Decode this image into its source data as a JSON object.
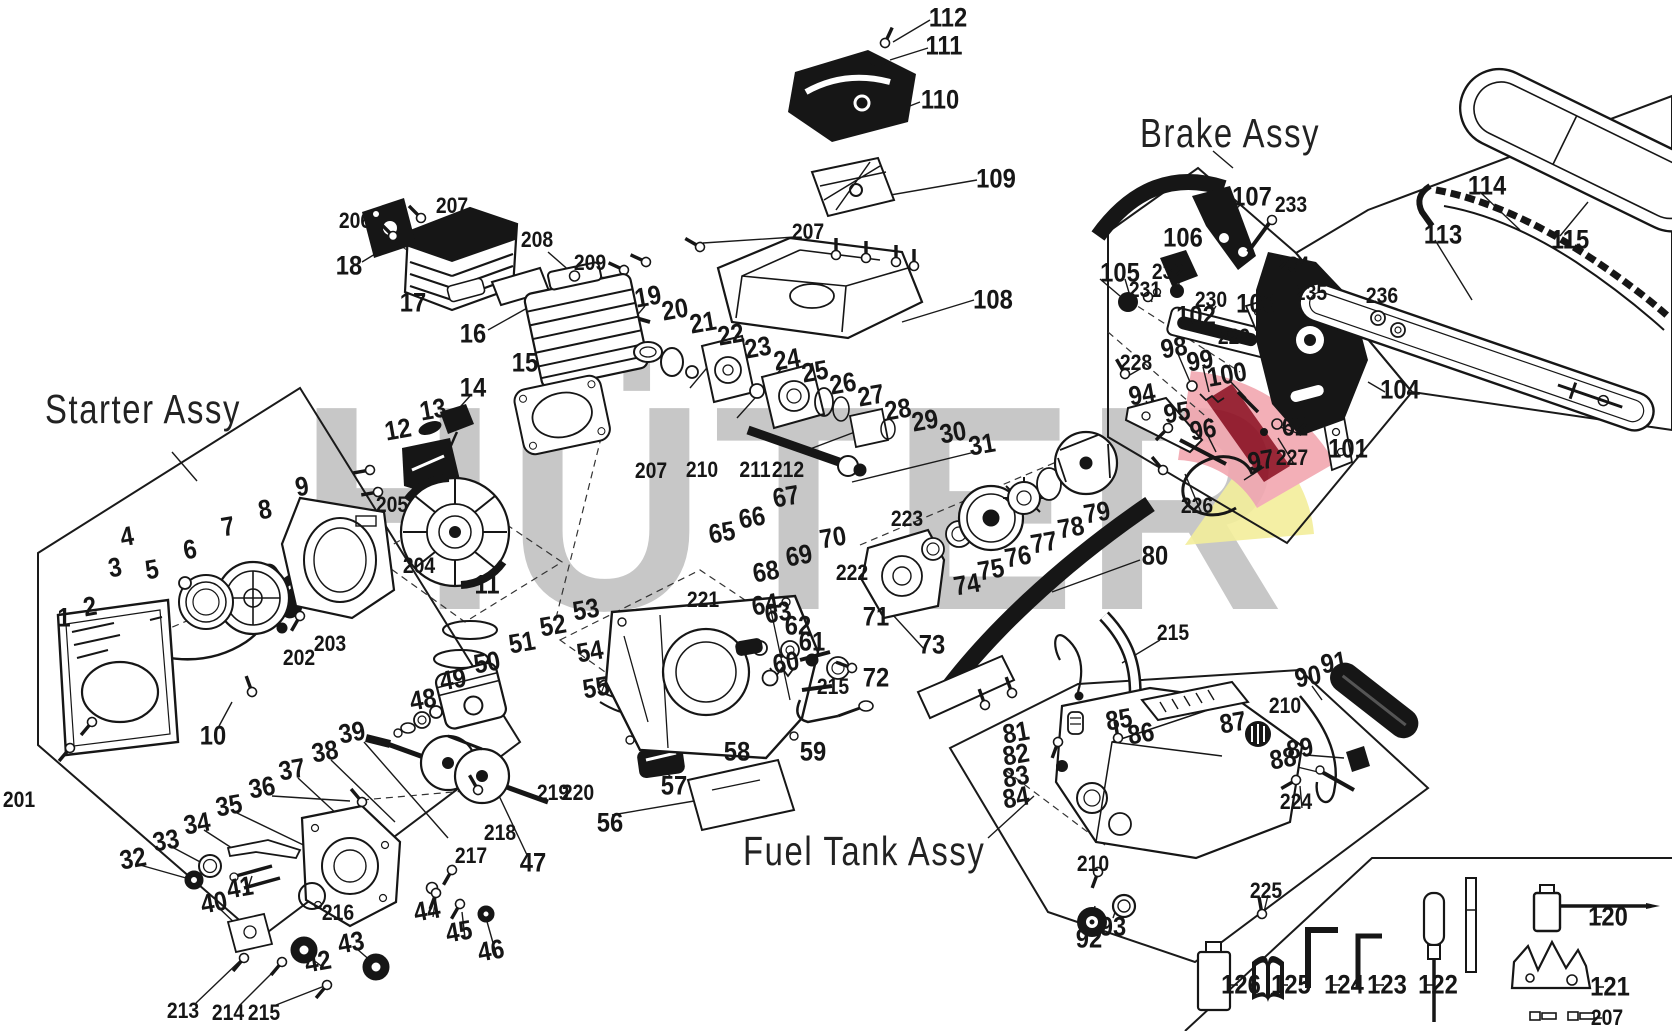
{
  "watermark": {
    "text": "HÜTER",
    "color": "#c7c7c7"
  },
  "logo_colors": {
    "pink": "#f2a7b0",
    "dark_red": "#8f1022",
    "yellow": "#f3ee9b"
  },
  "assy_labels": [
    {
      "id": "starter",
      "text": "Starter Assy"
    },
    {
      "id": "brake",
      "text": "Brake Assy"
    },
    {
      "id": "fuel",
      "text": "Fuel Tank Assy"
    }
  ],
  "legend_tools": [
    {
      "n": "126",
      "name": "oil-bottle"
    },
    {
      "n": "125",
      "name": "manual-book"
    },
    {
      "n": "124",
      "name": "hex-wrench-large"
    },
    {
      "n": "123",
      "name": "hex-wrench-small"
    },
    {
      "n": "122",
      "name": "screwdriver"
    },
    {
      "n": "120",
      "name": "spark-plug-wrench"
    },
    {
      "n": "121",
      "name": "bumper-spike"
    },
    {
      "n": "207",
      "name": "screws"
    }
  ],
  "callouts": [
    [
      "112",
      948,
      18,
      0
    ],
    [
      "111",
      944,
      46,
      0
    ],
    [
      "110",
      940,
      100,
      0
    ],
    [
      "109",
      996,
      179,
      0
    ],
    [
      "207",
      808,
      232,
      0
    ],
    [
      "108",
      993,
      300,
      0
    ],
    [
      "206",
      355,
      221,
      0
    ],
    [
      "207",
      452,
      206,
      0
    ],
    [
      "18",
      349,
      266,
      0
    ],
    [
      "17",
      413,
      303,
      0
    ],
    [
      "16",
      473,
      334,
      0
    ],
    [
      "208",
      537,
      240,
      0
    ],
    [
      "209",
      590,
      263,
      0
    ],
    [
      "15",
      525,
      363,
      0
    ],
    [
      "14",
      473,
      388,
      0
    ],
    [
      "13",
      433,
      410
    ],
    [
      "12",
      398,
      430
    ],
    [
      "19",
      648,
      297
    ],
    [
      "20",
      675,
      310
    ],
    [
      "21",
      703,
      323
    ],
    [
      "22",
      731,
      335
    ],
    [
      "23",
      758,
      348
    ],
    [
      "24",
      787,
      360
    ],
    [
      "25",
      815,
      372
    ],
    [
      "26",
      843,
      384
    ],
    [
      "27",
      871,
      396
    ],
    [
      "28",
      898,
      410
    ],
    [
      "29",
      925,
      421
    ],
    [
      "30",
      953,
      433
    ],
    [
      "31",
      982,
      445
    ],
    [
      "205",
      392,
      505,
      0
    ],
    [
      "204",
      419,
      566,
      0
    ],
    [
      "11",
      487,
      585,
      0
    ],
    [
      "207",
      651,
      471,
      0
    ],
    [
      "210",
      702,
      470,
      0
    ],
    [
      "211",
      755,
      470,
      0
    ],
    [
      "212",
      788,
      470,
      0
    ],
    [
      "4",
      127,
      537
    ],
    [
      "3",
      115,
      568
    ],
    [
      "5",
      152,
      570
    ],
    [
      "6",
      190,
      550
    ],
    [
      "7",
      228,
      527
    ],
    [
      "8",
      265,
      510
    ],
    [
      "9",
      302,
      487
    ],
    [
      "2",
      90,
      607
    ],
    [
      "1",
      64,
      618,
      0
    ],
    [
      "10",
      213,
      736,
      0
    ],
    [
      "201",
      19,
      800,
      0
    ],
    [
      "202",
      299,
      658,
      0
    ],
    [
      "203",
      330,
      644,
      0
    ],
    [
      "52",
      553,
      626
    ],
    [
      "53",
      586,
      610
    ],
    [
      "51",
      522,
      643
    ],
    [
      "50",
      487,
      663
    ],
    [
      "49",
      453,
      680
    ],
    [
      "48",
      423,
      700
    ],
    [
      "54",
      590,
      652
    ],
    [
      "55",
      596,
      688
    ],
    [
      "219",
      553,
      793,
      0
    ],
    [
      "220",
      578,
      793,
      0
    ],
    [
      "56",
      610,
      823,
      0
    ],
    [
      "57",
      674,
      786,
      0
    ],
    [
      "58",
      737,
      752,
      0
    ],
    [
      "59",
      813,
      752,
      0
    ],
    [
      "60",
      786,
      663
    ],
    [
      "215",
      833,
      687,
      0
    ],
    [
      "61",
      812,
      642,
      0
    ],
    [
      "62",
      798,
      626,
      0
    ],
    [
      "63",
      778,
      613
    ],
    [
      "64",
      765,
      605
    ],
    [
      "221",
      703,
      600,
      0
    ],
    [
      "65",
      722,
      533
    ],
    [
      "66",
      752,
      518
    ],
    [
      "67",
      786,
      497
    ],
    [
      "68",
      766,
      572
    ],
    [
      "69",
      799,
      556
    ],
    [
      "70",
      833,
      538
    ],
    [
      "222",
      852,
      573,
      0
    ],
    [
      "71",
      876,
      617,
      0
    ],
    [
      "72",
      876,
      678,
      0
    ],
    [
      "73",
      932,
      645,
      0
    ],
    [
      "223",
      907,
      519,
      0
    ],
    [
      "74",
      967,
      585
    ],
    [
      "75",
      991,
      570
    ],
    [
      "76",
      1018,
      557
    ],
    [
      "77",
      1044,
      543
    ],
    [
      "78",
      1071,
      528
    ],
    [
      "79",
      1097,
      513
    ],
    [
      "80",
      1155,
      556,
      0
    ],
    [
      "34",
      197,
      824
    ],
    [
      "35",
      229,
      806
    ],
    [
      "36",
      262,
      788
    ],
    [
      "37",
      292,
      770
    ],
    [
      "38",
      325,
      752
    ],
    [
      "39",
      352,
      733
    ],
    [
      "33",
      166,
      841
    ],
    [
      "32",
      133,
      859
    ],
    [
      "41",
      240,
      888
    ],
    [
      "40",
      214,
      903
    ],
    [
      "216",
      338,
      913,
      0
    ],
    [
      "218",
      500,
      833,
      0
    ],
    [
      "217",
      471,
      856,
      0
    ],
    [
      "44",
      427,
      911
    ],
    [
      "45",
      459,
      932
    ],
    [
      "46",
      491,
      951
    ],
    [
      "43",
      351,
      943
    ],
    [
      "42",
      318,
      962
    ],
    [
      "213",
      183,
      1011,
      0
    ],
    [
      "214",
      228,
      1013,
      0
    ],
    [
      "215",
      264,
      1013,
      0
    ],
    [
      "47",
      533,
      863,
      0
    ],
    [
      "107",
      1252,
      197,
      0
    ],
    [
      "233",
      1291,
      205,
      0
    ],
    [
      "106",
      1183,
      238,
      0
    ],
    [
      "232",
      1168,
      272,
      0
    ],
    [
      "105",
      1120,
      273,
      0
    ],
    [
      "231",
      1145,
      290,
      0
    ],
    [
      "230",
      1211,
      300,
      0
    ],
    [
      "102",
      1196,
      316,
      0
    ],
    [
      "103",
      1256,
      304,
      0
    ],
    [
      "234",
      1293,
      265,
      0
    ],
    [
      "235",
      1311,
      293,
      0
    ],
    [
      "229",
      1234,
      337,
      0
    ],
    [
      "98",
      1174,
      348
    ],
    [
      "99",
      1200,
      361
    ],
    [
      "228",
      1136,
      363,
      0
    ],
    [
      "100",
      1227,
      375
    ],
    [
      "94",
      1142,
      395
    ],
    [
      "95",
      1177,
      413
    ],
    [
      "96",
      1203,
      430
    ],
    [
      "62",
      1295,
      427,
      0
    ],
    [
      "227",
      1292,
      458,
      0
    ],
    [
      "97",
      1261,
      461
    ],
    [
      "226",
      1197,
      506,
      0
    ],
    [
      "101",
      1348,
      449,
      0
    ],
    [
      "104",
      1400,
      390,
      0
    ],
    [
      "114",
      1487,
      186,
      0
    ],
    [
      "113",
      1443,
      235,
      0
    ],
    [
      "115",
      1570,
      240,
      0
    ],
    [
      "236",
      1382,
      296,
      0
    ],
    [
      "81",
      1016,
      733
    ],
    [
      "82",
      1016,
      755
    ],
    [
      "83",
      1016,
      777
    ],
    [
      "84",
      1016,
      798
    ],
    [
      "85",
      1119,
      720
    ],
    [
      "86",
      1141,
      734
    ],
    [
      "87",
      1233,
      723
    ],
    [
      "215",
      1173,
      633,
      0
    ],
    [
      "210",
      1093,
      864,
      0
    ],
    [
      "92",
      1089,
      939,
      0
    ],
    [
      "93",
      1113,
      927,
      0
    ],
    [
      "90",
      1308,
      677
    ],
    [
      "91",
      1334,
      663
    ],
    [
      "210",
      1285,
      706,
      0
    ],
    [
      "88",
      1283,
      759
    ],
    [
      "89",
      1300,
      749
    ],
    [
      "224",
      1296,
      802,
      0
    ],
    [
      "225",
      1266,
      891,
      0
    ],
    [
      "120",
      1608,
      917,
      0
    ],
    [
      "121",
      1610,
      987,
      0
    ],
    [
      "122",
      1438,
      985,
      0
    ],
    [
      "123",
      1387,
      985,
      0
    ],
    [
      "124",
      1344,
      985,
      0
    ],
    [
      "125",
      1291,
      985,
      0
    ],
    [
      "126",
      1241,
      985,
      0
    ],
    [
      "207",
      1607,
      1018,
      0
    ]
  ]
}
